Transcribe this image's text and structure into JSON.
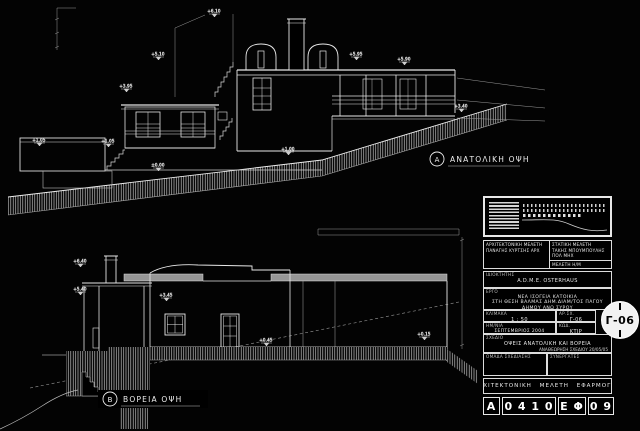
{
  "sheet": {
    "bg": "#030303",
    "line": "#e8e8e8"
  },
  "east": {
    "tag": "A",
    "label": "ΑΝΑΤΟΛΙΚΗ ΟΨΗ",
    "levels": [
      "+1.05",
      "+1.05",
      "+3.95",
      "+5.10",
      "+6.10",
      "±0.00",
      "+1.00",
      "+5.95",
      "+5.90",
      "+3.40"
    ]
  },
  "north": {
    "tag": "B",
    "label": "ΒΟΡΕΙΑ ΟΨΗ",
    "levels": [
      "+6.40",
      "+5.40",
      "+3.45",
      "+0.45",
      "+0.15"
    ]
  },
  "titleblock": {
    "architect": {
      "role": "ΑΡΧΙΤΕΚΤΟΝΙΚΗ ΜΕΛΕΤΗ",
      "name": "ΠΑΝΑΓΗΣ ΚΥΡΤΣΗΣ ΑΡΧ"
    },
    "structural": {
      "role": "ΣΤΑΤΙΚΗ ΜΕΛΕΤΗ",
      "name": "ΤΑΚΗΣ ΜΠΟΥΜΠΟΥΛΗΣ ΠΟΛ ΜΗΧ"
    },
    "mep": {
      "role": "ΜΕΛΕΤΗ Η/Μ",
      "name": "ΤΑΚΗΣ ΒΕΝΕΔΙΚΤΟΣ Η/Μ ΜΗΧ"
    },
    "owner": {
      "label": "ΙΔΙΟΚΤΗΤΗΣ",
      "name": "A.D.M.E. OSTERHAUS"
    },
    "project": {
      "label": "ΕΡΓΟ",
      "line1": "ΝΕΑ ΙΣΟΓΕΙΑ ΚΑΤΟΙΚΙΑ",
      "line2": "ΣΤΗ ΘΕΣΗ ΒΑΛΜΑΣ ΔΗΜ.ΔΙΑΜ/ΤΟΣ ΠΑΓΟΥ",
      "line3": "ΔΗΜΟΥ ΑΝΩ ΣΥΡΟΥ"
    },
    "scale": {
      "label": "ΚΛΙΜΑΚΑ",
      "value": "1 : 50"
    },
    "date": {
      "label": "ΗΜ/ΝΙΑ",
      "value": "ΣΕΠΤΕΜΒΡΙΟΣ 2004"
    },
    "number": {
      "label": "ΑΡ.ΣΧ.",
      "value": "Γ-06"
    },
    "code": {
      "label": "ΚΩΔ.",
      "value": "ΚΤΙΡ"
    },
    "drawing": {
      "label": "ΣΧΕΔΙΟ",
      "title": "ΟΨΕΙΣ ΑΝΑΤΟΛΙΚΗ ΚΑΙ ΒΟΡΕΙΑ",
      "revision": "ΑΝΑΘΕΩΡΗΣΗ ΣΧΕΔΙΟΥ  20/05/05"
    },
    "team": {
      "label": "ΟΜΑΔΑ ΣΧΕΔΙΑΣΗΣ"
    },
    "partners": {
      "label": "ΣΥΝΕΡΓΑΤΕΣ"
    },
    "phase": "ΑΡΧΙΤΕΚΤΟΝΙΚΗ ΜΕΛΕΤΗ ΕΦΑΡΜΟΓΗΣ",
    "badge": "Γ-06",
    "codes": [
      "Α",
      "0 4 1 0",
      "Ε Φ",
      "0 9"
    ]
  }
}
